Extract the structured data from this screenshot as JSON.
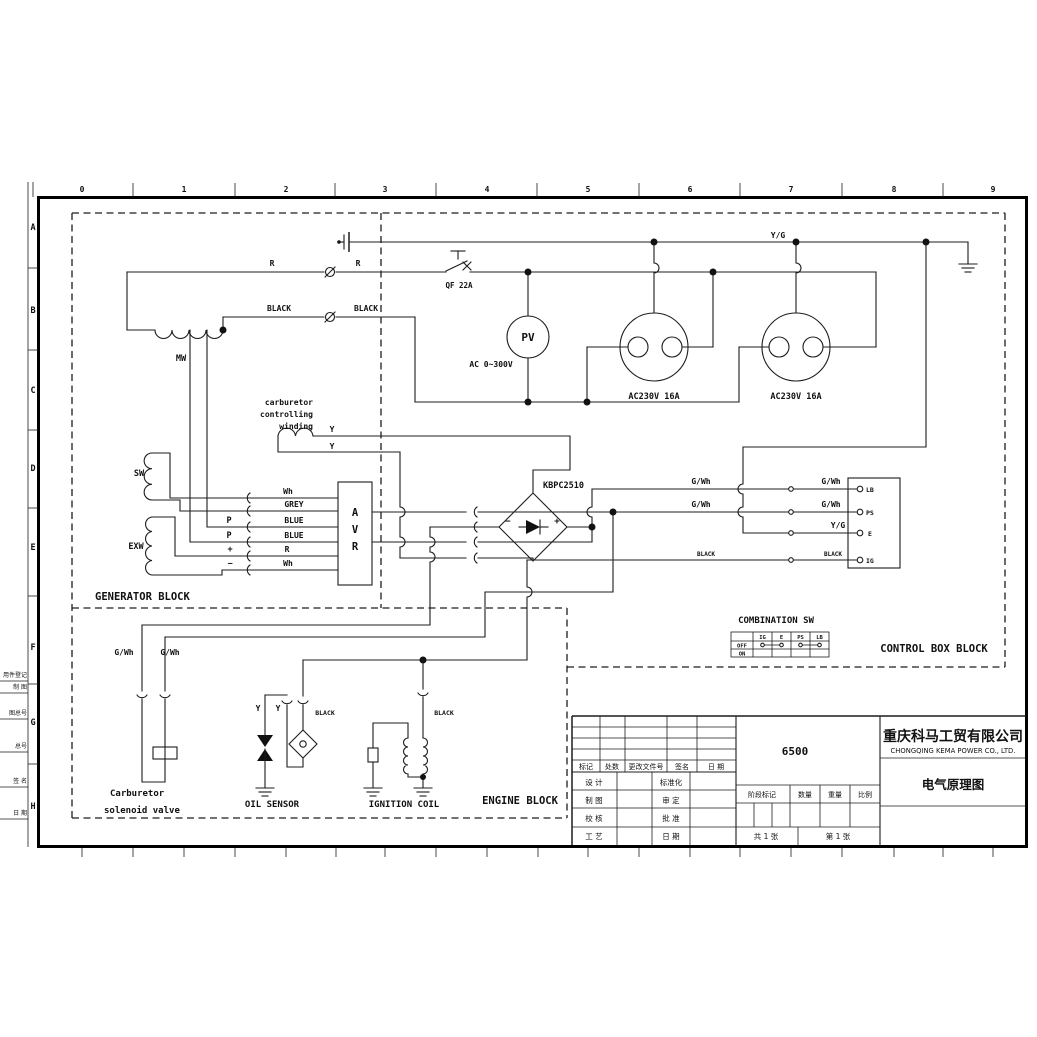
{
  "ruler": [
    "0",
    "1",
    "2",
    "3",
    "4",
    "5",
    "6",
    "7",
    "8",
    "9"
  ],
  "rows": [
    "A",
    "B",
    "C",
    "D",
    "E",
    "F",
    "G",
    "H"
  ],
  "margin": [
    "用件登记",
    "制 图",
    "图总号",
    "总号",
    "签 名",
    "日 期"
  ],
  "blocks": {
    "generator": "GENERATOR BLOCK",
    "control": "CONTROL BOX BLOCK",
    "engine": "ENGINE BLOCK",
    "combination": "COMBINATION SW"
  },
  "labels": {
    "r": "R",
    "black": "BLACK",
    "mw": "MW",
    "qf": "QF 22A",
    "pv": "PV",
    "ac_range": "AC 0~300V",
    "socket": "AC230V 16A",
    "yg": "Y/G",
    "y": "Y",
    "wh": "Wh",
    "grey": "GREY",
    "blue": "BLUE",
    "p": "P",
    "plus": "+",
    "minus": "−",
    "sw": "SW",
    "exw": "EXW",
    "avr_a": "A",
    "avr_v": "V",
    "avr_r": "R",
    "kbpc": "KBPC2510",
    "gwh": "G/Wh",
    "carb_l1": "carburetor",
    "carb_l2": "controlling",
    "carb_l3": "winding",
    "valve_l1": "Carburetor",
    "valve_l2": "solenoid valve",
    "oil_sensor": "OIL SENSOR",
    "ignition_coil": "IGNITION COIL"
  },
  "terminals": [
    "LB",
    "PS",
    "E",
    "IG"
  ],
  "combination_table": {
    "headers": [
      "IG",
      "E",
      "PS",
      "LB"
    ],
    "row_off": "OFF",
    "row_on": "ON"
  },
  "title_block": {
    "rev_headers": [
      "标记",
      "处数",
      "更改文件号",
      "签名",
      "日 期"
    ],
    "left_rows": [
      [
        "设 计",
        "标准化"
      ],
      [
        "制 图",
        "审 定"
      ],
      [
        "校 核",
        "批 准"
      ],
      [
        "工 艺",
        "日 期"
      ]
    ],
    "model": "6500",
    "stage_headers": [
      "阶段标记",
      "数量",
      "重量",
      "比例"
    ],
    "sheets_total": "共 1 张",
    "sheet_no": "第 1 张",
    "company_cn": "重庆科马工贸有限公司",
    "company_en": "CHONGQING KEMA POWER CO., LTD.",
    "drawing_title": "电气原理图"
  }
}
